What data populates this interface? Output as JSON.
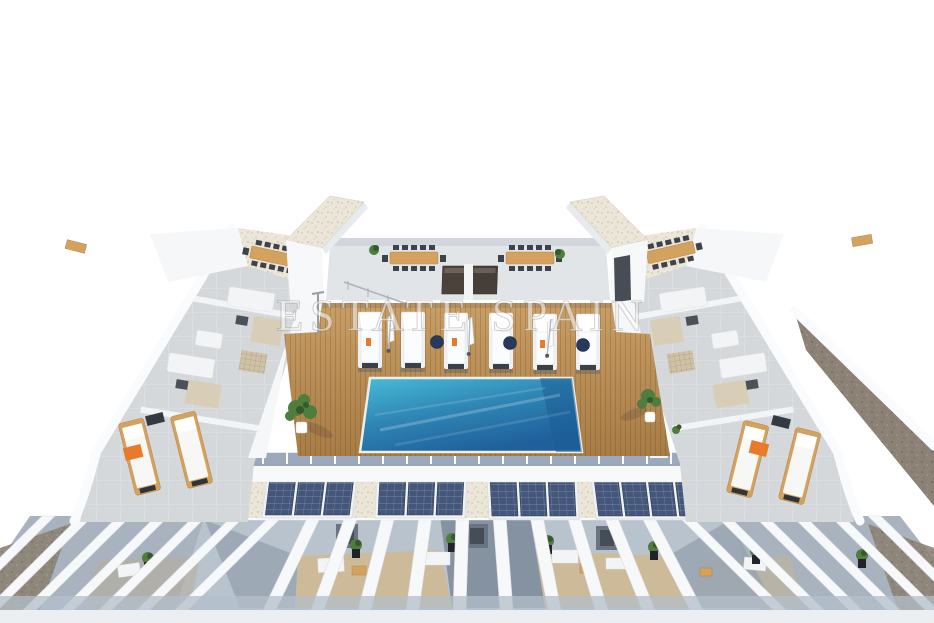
{
  "scene": {
    "type": "architectural-3d-render",
    "subject": "Aerial 3D render of a residential rooftop solarium: communal swimming pool set in a wooden sun deck with a row of white loungers and parasols, flanking grey tiled terraces with outdoor sofas and wooden loungers, two white stair towers with gravel tops, rooftop dining tables with barbecue units, four solar-panel arrays and white pergola slats over the lower-level terraces",
    "watermark": "ESTATE SPAIN"
  },
  "counts": {
    "sun_loungers_on_deck": 6,
    "parasols_on_deck": 3,
    "navy_poufs": 3,
    "solar_panel_arrays": 4,
    "stair_towers": 2,
    "dining_tables": 4,
    "barbecue_units": 2,
    "wooden_loungers_side_terraces": 4
  },
  "colors": {
    "background": "#ffffff",
    "pool_light": "#48bcd8",
    "pool_mid": "#2f86b5",
    "pool_dark": "#1f5f9b",
    "deck_light": "#c99f66",
    "deck_dark": "#a87c45",
    "terrace_grey": "#d5d8db",
    "gravel_beige": "#ece6d8",
    "gravel_brown": "#8c8275",
    "solar_panel": "#44567a",
    "plant_green": "#4e7d3e",
    "plant_dark": "#35592b",
    "wood_furniture": "#d3a25e",
    "accent_orange": "#e87a2c",
    "navy_pouf": "#27395c",
    "shadow_blue": "#8fa0b4",
    "pergola_shadow": "#b3bfca",
    "ground_strip": "#eceff2"
  }
}
